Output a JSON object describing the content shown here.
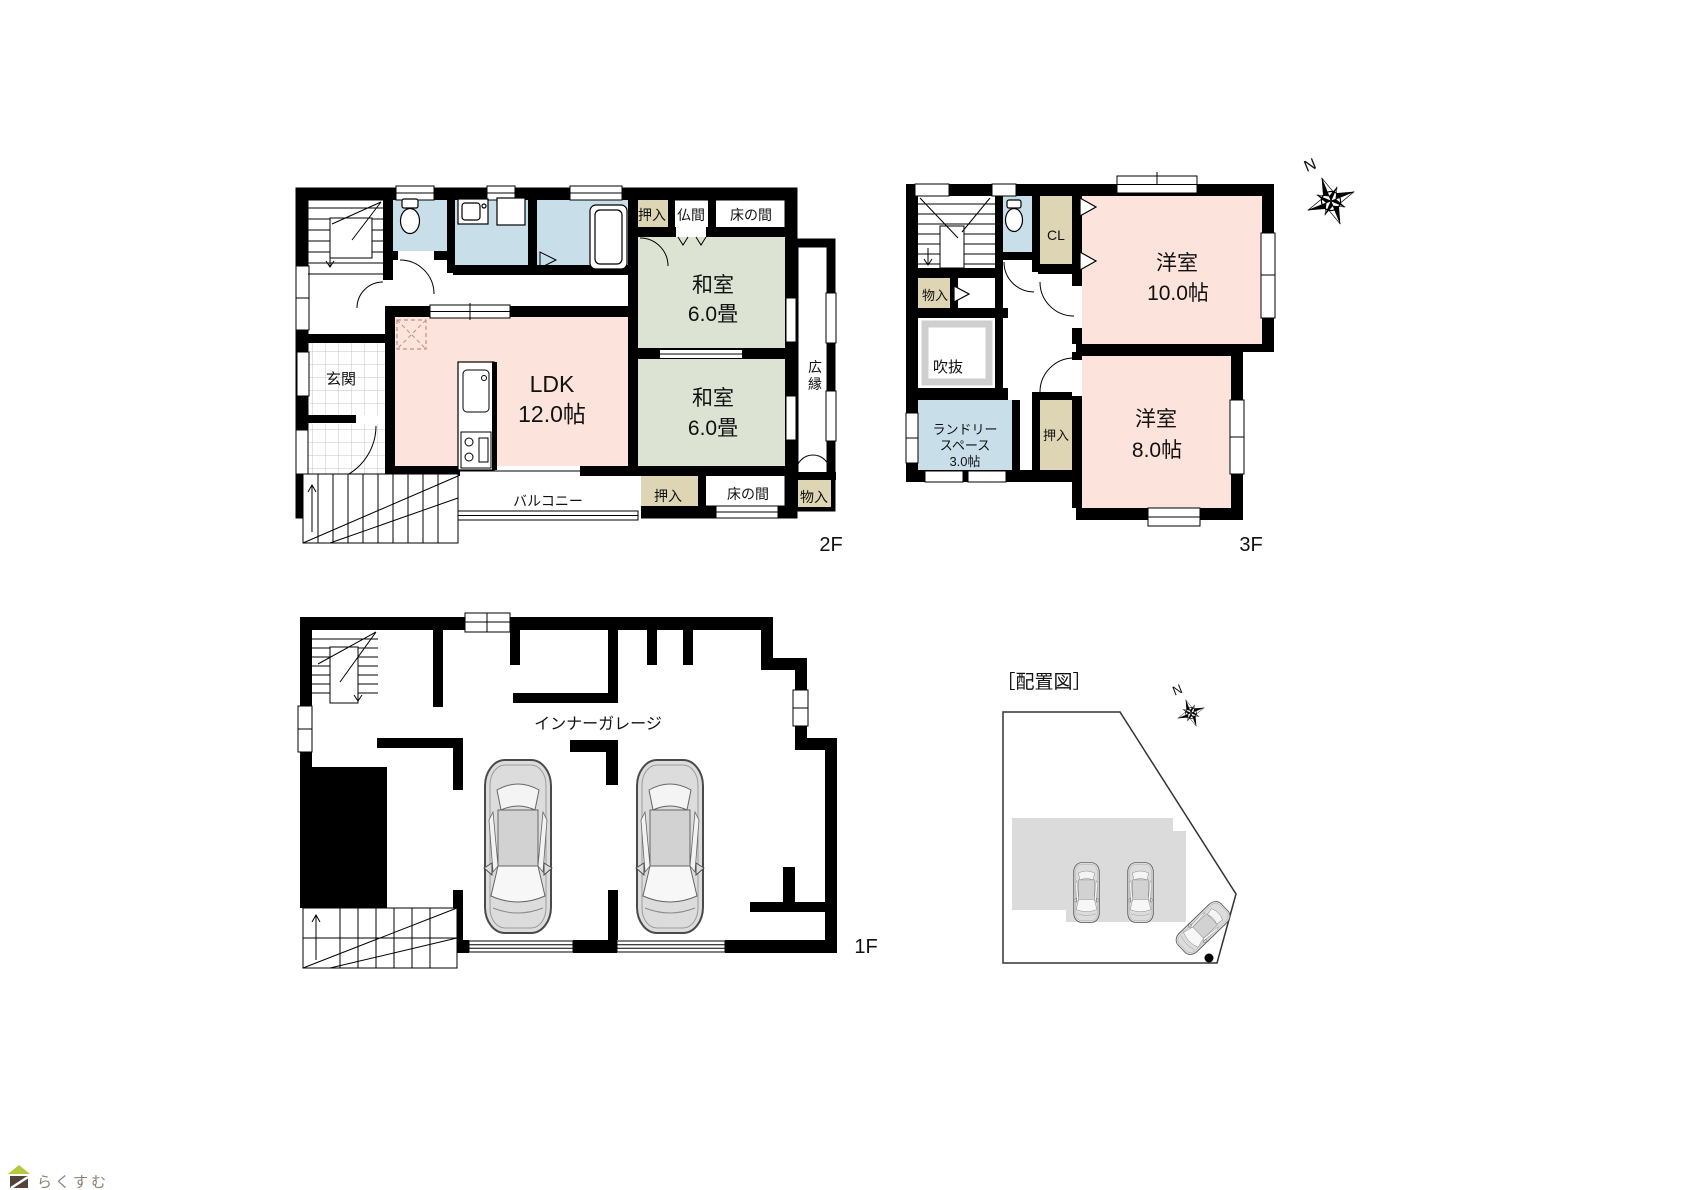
{
  "colors": {
    "wall": "#000000",
    "wet_room_blue": "#c8dfe9",
    "tatami_green": "#dce3d3",
    "western_pink": "#fce4dd",
    "closet_tan": "#ded5b4",
    "site_building_gray": "#dbdbdb",
    "logo_roof_green": "#b5c93c",
    "logo_body_brown": "#54433a",
    "logo_text_brown": "#8c8073"
  },
  "floor2": {
    "floor_label": "2F",
    "oshiire_top": "押入",
    "butsuma": "仏間",
    "tokonoma_top": "床の間",
    "washitsu_top_name": "和室",
    "washitsu_top_size": "6.0畳",
    "washitsu_bottom_name": "和室",
    "washitsu_bottom_size": "6.0畳",
    "hiroen_1": "広",
    "hiroen_2": "縁",
    "genkan": "玄関",
    "ldk_name": "LDK",
    "ldk_size": "12.0帖",
    "balcony": "バルコニー",
    "oshiire_bottom": "押入",
    "tokonoma_bottom": "床の間",
    "monoire": "物入"
  },
  "floor3": {
    "floor_label": "3F",
    "compass_north": "N",
    "cl": "CL",
    "yoshitsu10_name": "洋室",
    "yoshitsu10_size": "10.0帖",
    "monoire": "物入",
    "fukinuke": "吹抜",
    "laundry_1": "ランドリー",
    "laundry_2": "スペース",
    "laundry_3": "3.0帖",
    "oshiire": "押入",
    "yoshitsu8_name": "洋室",
    "yoshitsu8_size": "8.0帖"
  },
  "floor1": {
    "floor_label": "1F",
    "garage": "インナーガレージ"
  },
  "site": {
    "title": "［配置図］",
    "compass_north": "N"
  },
  "logo": {
    "text": "らくすむ"
  }
}
